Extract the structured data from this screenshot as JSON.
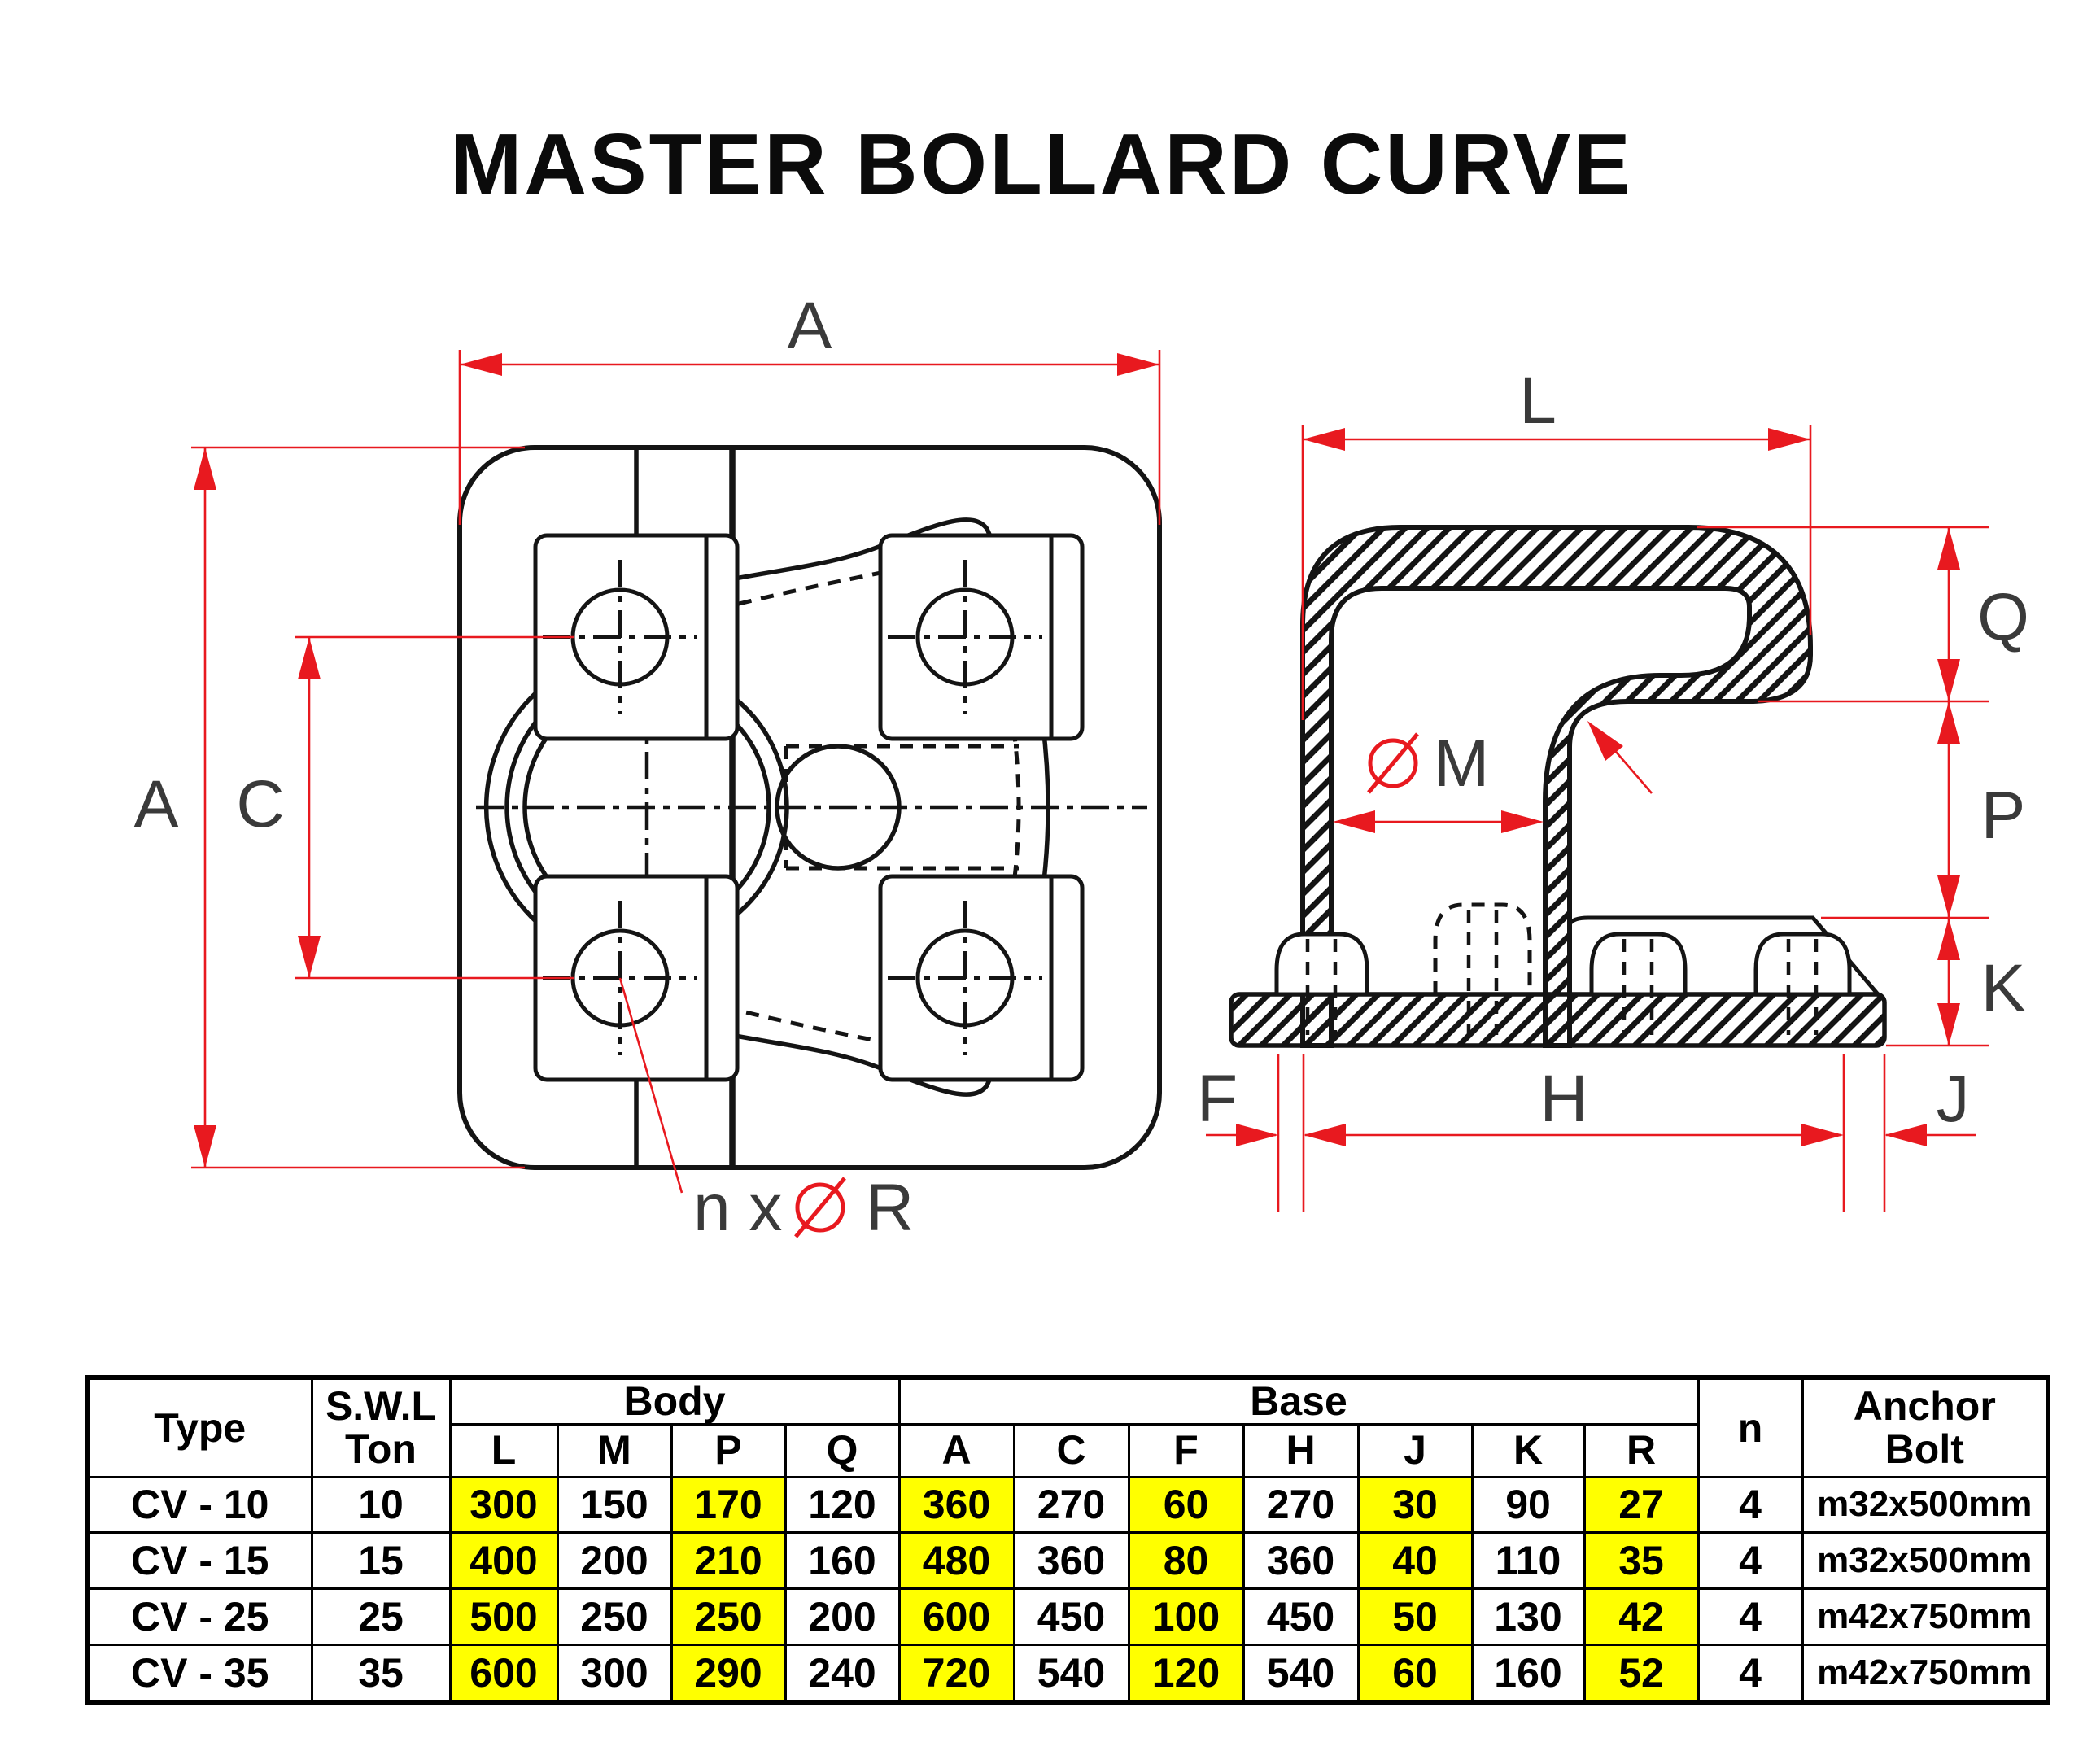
{
  "title": "MASTER BOLLARD CURVE",
  "colors": {
    "dimension_red": "#e8191f",
    "highlight_yellow": "#ffff00",
    "line_black": "#141414"
  },
  "plan_view": {
    "dim_width": "A",
    "dim_height": "A",
    "dim_bolt_span": "C",
    "bolt_note_prefix": "n x",
    "bolt_note_dia_symbol": "⌀",
    "bolt_note_suffix": "R"
  },
  "side_view": {
    "dim_length": "L",
    "dim_q": "Q",
    "dim_p": "P",
    "dim_k": "K",
    "dia_symbol": "⌀",
    "dia_label": "M",
    "dim_f": "F",
    "dim_h": "H",
    "dim_j": "J"
  },
  "table": {
    "headers": {
      "type": "Type",
      "swl_line1": "S.W.L",
      "swl_line2": "Ton",
      "body": "Body",
      "base": "Base",
      "n": "n",
      "anchor_line1": "Anchor",
      "anchor_line2": "Bolt",
      "body_cols": [
        "L",
        "M",
        "P",
        "Q"
      ],
      "base_cols": [
        "A",
        "C",
        "F",
        "H",
        "J",
        "K",
        "R"
      ]
    },
    "highlight_columns": [
      "L",
      "P",
      "A",
      "F",
      "J",
      "R"
    ],
    "rows": [
      {
        "type": "CV - 10",
        "swl": "10",
        "L": "300",
        "M": "150",
        "P": "170",
        "Q": "120",
        "A": "360",
        "C": "270",
        "F": "60",
        "H": "270",
        "J": "30",
        "K": "90",
        "R": "27",
        "n": "4",
        "anchor": "m32x500mm"
      },
      {
        "type": "CV - 15",
        "swl": "15",
        "L": "400",
        "M": "200",
        "P": "210",
        "Q": "160",
        "A": "480",
        "C": "360",
        "F": "80",
        "H": "360",
        "J": "40",
        "K": "110",
        "R": "35",
        "n": "4",
        "anchor": "m32x500mm"
      },
      {
        "type": "CV - 25",
        "swl": "25",
        "L": "500",
        "M": "250",
        "P": "250",
        "Q": "200",
        "A": "600",
        "C": "450",
        "F": "100",
        "H": "450",
        "J": "50",
        "K": "130",
        "R": "42",
        "n": "4",
        "anchor": "m42x750mm"
      },
      {
        "type": "CV - 35",
        "swl": "35",
        "L": "600",
        "M": "300",
        "P": "290",
        "Q": "240",
        "A": "720",
        "C": "540",
        "F": "120",
        "H": "540",
        "J": "60",
        "K": "160",
        "R": "52",
        "n": "4",
        "anchor": "m42x750mm"
      }
    ]
  }
}
